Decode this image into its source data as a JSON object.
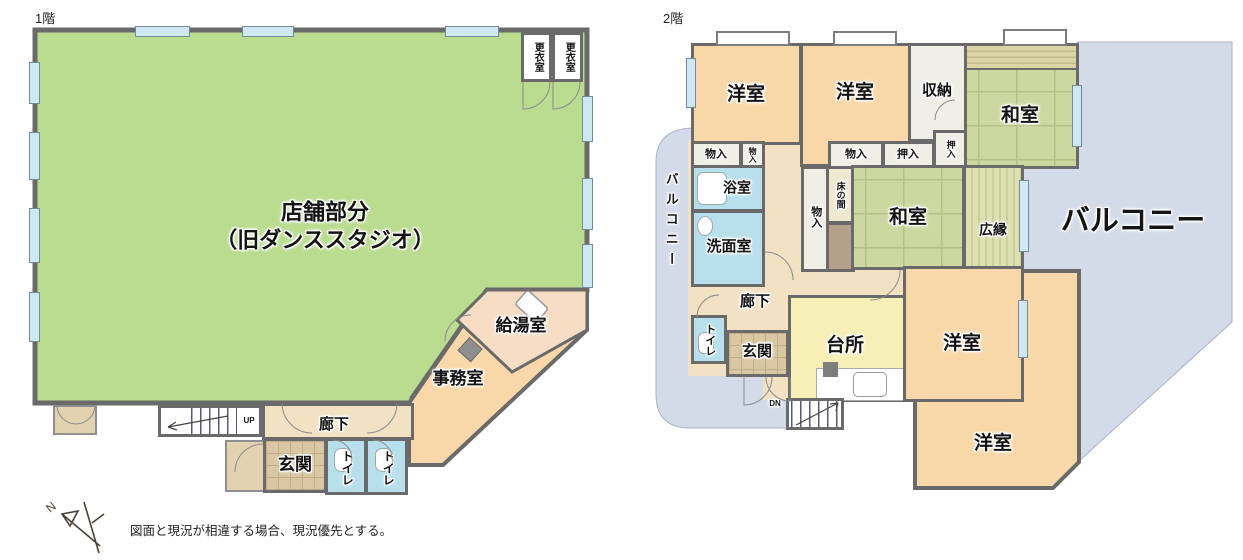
{
  "floor1": {
    "title": "1階",
    "rooms": {
      "store1": "店舗部分",
      "store2": "（旧ダンススタジオ）",
      "changing1": "更衣室",
      "changing2": "更衣室",
      "kitchenette": "給湯室",
      "office": "事務室",
      "hallway": "廊下",
      "entrance": "玄関",
      "toilet1": "トイレ",
      "toilet2": "トイレ",
      "up": "UP"
    }
  },
  "floor2": {
    "title": "2階",
    "rooms": {
      "western1": "洋室",
      "western2": "洋室",
      "storage": "収納",
      "japanese1": "和室",
      "closet1": "物入",
      "closet2": "物入",
      "closet3": "物入",
      "oshiire1": "押入",
      "oshiire2": "押入",
      "bath": "浴室",
      "washroom": "洗面室",
      "closet4": "物入",
      "tokonoma": "床の間",
      "japanese2": "和室",
      "veranda": "広縁",
      "hallway": "廊下",
      "toilet": "トイレ",
      "entrance": "玄関",
      "kitchen": "台所",
      "western3": "洋室",
      "western4": "洋室",
      "balcony_left": "バルコニー",
      "balcony_main": "バルコニー",
      "down": "DN"
    }
  },
  "footer": {
    "note": "図面と現況が相違する場合、現況優先とする。",
    "compass_north": "N"
  },
  "colors": {
    "wall": "#6a6a6a",
    "store_green": "#b9dc8e",
    "room_peach": "#f8d8a8",
    "kitchenette_peach": "#f6ddc4",
    "tatami_green": "#cdd8a0",
    "water_blue": "#b7e0ec",
    "balcony_blue": "#d4dbe8",
    "kitchen_yellow": "#f7f0b6"
  }
}
